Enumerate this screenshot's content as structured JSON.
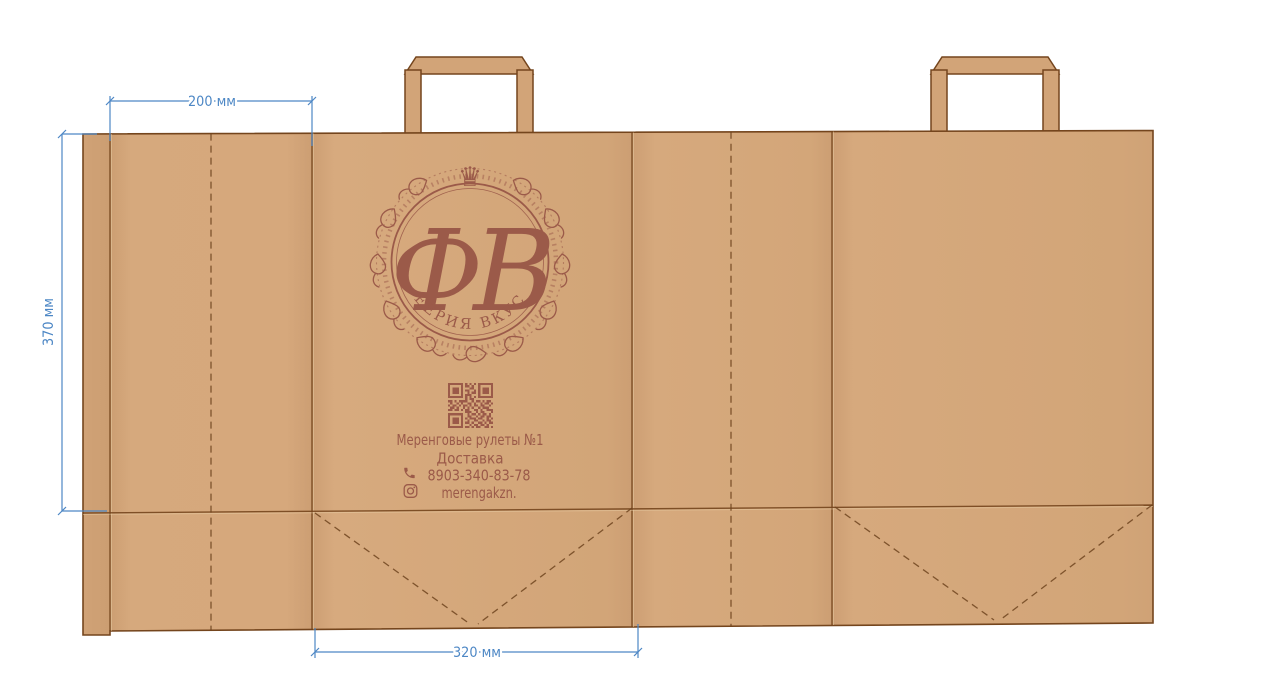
{
  "artboard": {
    "background": "#ffffff"
  },
  "dieline": {
    "paper_color": "#d5a87c",
    "outline_color": "#74451d",
    "print_color": "#9b5a49",
    "dimension_color": "#4d87c5",
    "labels": {
      "gusset_width": "200 мм",
      "bag_height": "370 мм",
      "panel_width": "320 мм"
    }
  },
  "print": {
    "logo": {
      "monogram": "ФВ",
      "ring_text": "ФЕЕРИЯ ВКУСА",
      "crown": "♛"
    },
    "contact": {
      "line1": "Меренговые рулеты №1",
      "line2": "Доставка",
      "phone": "8903-340-83-78",
      "instagram": "merengakzn."
    },
    "qr_matrix": [
      "111111101010101111111",
      "100000101101001000001",
      "101110100011001011101",
      "101110101100101011101",
      "101110100101101011101",
      "100000101110001000001",
      "111111101010101111111",
      "000000001011000000000",
      "110101111001011010110",
      "010010100110100101101",
      "101101011010110110010",
      "011010010101001011100",
      "110110101100110100111",
      "000000001110010110001",
      "111111100101101011010",
      "100000100110010110110",
      "101110101011101100101",
      "101110100100110010110",
      "101110101101001101011",
      "100000100010110110100",
      "111111101101011001101"
    ]
  }
}
